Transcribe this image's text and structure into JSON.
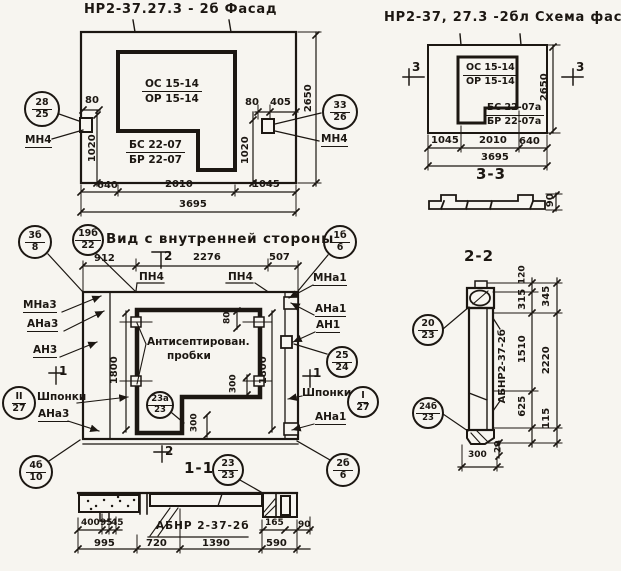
{
  "colors": {
    "ink": "#1c1712",
    "paper": "#f7f5f0"
  },
  "facade": {
    "title": "НР2-37.27.3 - 2б Фасад",
    "mark_top": {
      "line1": "ОС 15-14",
      "line2": "ОР 15-14"
    },
    "mark_bottom": {
      "line1": "БС 22-07",
      "line2": "БР 22-07"
    },
    "callout_left": {
      "top": "28",
      "bottom": "25"
    },
    "callout_left_label": "МН4",
    "callout_right": {
      "top": "33",
      "bottom": "26"
    },
    "callout_right_label": "МН4",
    "dims": {
      "left_offset": "80",
      "left_height": "1020",
      "right_offset": "80",
      "right_inset": "405",
      "right_height": "1020",
      "total_height": "2650",
      "seg1": "640",
      "seg2": "2010",
      "seg3": "1045",
      "total_width": "3695"
    }
  },
  "scheme": {
    "title": "НР2-37, 27.3 -2бл Схема фасада",
    "mark_top": {
      "line1": "ОС 15-14",
      "line2": "ОР 15-14"
    },
    "mark_bottom": {
      "line1": "БС 22-07а",
      "line2": "БР 22-07а"
    },
    "marker_left": "3",
    "marker_right": "3",
    "dims": {
      "height": "2650",
      "seg1": "1045",
      "seg2": "2010",
      "seg3": "640",
      "total_width": "3695"
    }
  },
  "section33": {
    "title": "3-3",
    "dim_height": "90"
  },
  "inner": {
    "title": "Вид с внутренней стороны",
    "note": {
      "line1": "Антисептирован.",
      "line2": "пробки"
    },
    "marker_top": "2",
    "marker_bottom": "2",
    "marker_left": "1",
    "marker_right": "1",
    "labels": {
      "pn4_a": "ПН4",
      "pn4_b": "ПН4",
      "mna3": "МНа3",
      "ana3_a": "АНа3",
      "an3": "АН3",
      "shponki_left": "Шпонки",
      "ana3_b": "АНа3",
      "mna1": "МНа1",
      "ana1_a": "АНа1",
      "an1": "АН1",
      "shponki_right": "Шпонки",
      "ana1_b": "АНа1"
    },
    "callouts": {
      "c3b": {
        "top": "3б",
        "bottom": "8"
      },
      "c19b": {
        "top": "19б",
        "bottom": "22"
      },
      "c1b": {
        "top": "1б",
        "bottom": "6"
      },
      "c25": {
        "top": "25",
        "bottom": "24"
      },
      "cI": {
        "top": "I",
        "bottom": "27"
      },
      "cII": {
        "top": "II",
        "bottom": "27"
      },
      "c23a": {
        "top": "23а",
        "bottom": "23"
      },
      "c4b": {
        "top": "4б",
        "bottom": "10"
      },
      "c2b": {
        "top": "2б",
        "bottom": "6"
      }
    },
    "dims": {
      "seg1": "912",
      "seg2": "2276",
      "seg3": "507",
      "height_left": "1800",
      "height_right": "1800",
      "small_top": "80",
      "small_right": "300",
      "small_notch": "300"
    }
  },
  "section11": {
    "title": "1-1",
    "label": "АБНР 2-37-2б",
    "callout": {
      "top": "23",
      "bottom": "23"
    },
    "dims": {
      "d1": "400",
      "d2": "95",
      "d3": "45",
      "d4": "165",
      "d5": "90",
      "seg1": "995",
      "seg2": "720",
      "seg3": "1390",
      "seg4": "590"
    }
  },
  "section22": {
    "title": "2-2",
    "label": "АБНР2-37-2б",
    "callout_top": {
      "top": "20",
      "bottom": "23"
    },
    "callout_bottom": {
      "top": "24б",
      "bottom": "23"
    },
    "dims": {
      "d120": "120",
      "d315": "315",
      "d1510": "1510",
      "d625": "625",
      "d115": "115",
      "d345": "345",
      "d2220": "2220",
      "d20": "20",
      "d300": "300"
    }
  }
}
